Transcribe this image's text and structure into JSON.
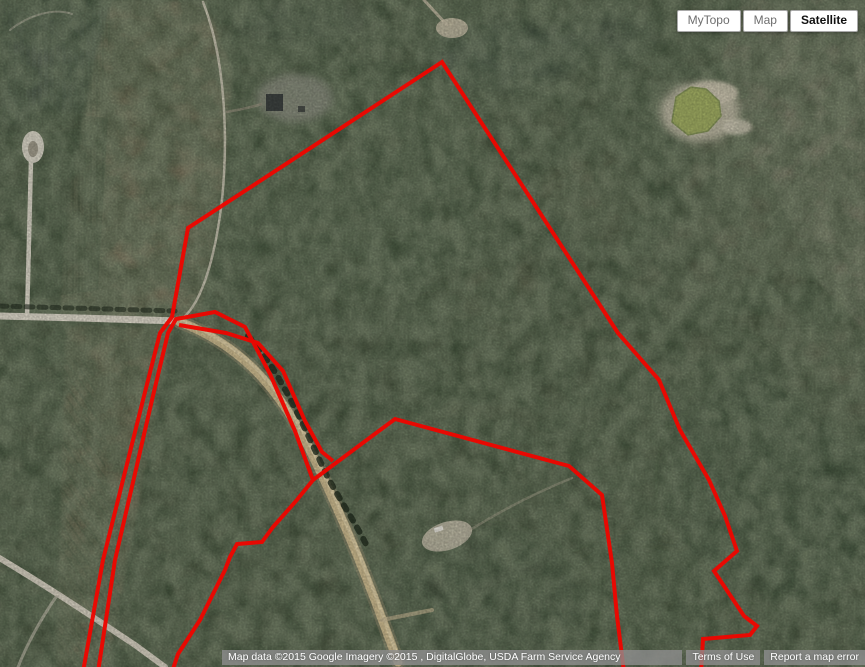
{
  "map_controls": {
    "buttons": [
      {
        "id": "mytopo",
        "label": "MyTopo",
        "active": false
      },
      {
        "id": "map",
        "label": "Map",
        "active": false
      },
      {
        "id": "satellite",
        "label": "Satellite",
        "active": true
      }
    ]
  },
  "attribution": {
    "map_data": "Map data ©2015 Google Imagery ©2015 , DigitalGlobe, USDA Farm Service Agency",
    "terms_of_use": "Terms of Use",
    "report_error": "Report a map error"
  },
  "overlay": {
    "stroke_color": "#ee0600",
    "stroke_width": 4,
    "polylines": [
      {
        "name": "main-parcel-boundary",
        "points": [
          [
            83,
            672
          ],
          [
            103,
            560
          ],
          [
            143,
            400
          ],
          [
            160,
            333
          ],
          [
            172,
            317
          ],
          [
            188,
            228
          ],
          [
            442,
            62
          ],
          [
            618,
            333
          ],
          [
            659,
            380
          ],
          [
            680,
            430
          ],
          [
            709,
            480
          ],
          [
            725,
            516
          ],
          [
            737,
            551
          ],
          [
            714,
            571
          ],
          [
            744,
            616
          ],
          [
            757,
            626
          ],
          [
            750,
            635
          ],
          [
            703,
            639
          ],
          [
            701,
            672
          ]
        ]
      },
      {
        "name": "west-strip-boundary",
        "points": [
          [
            98,
            672
          ],
          [
            115,
            560
          ],
          [
            152,
            400
          ],
          [
            168,
            333
          ],
          [
            176,
            319
          ],
          [
            215,
            312
          ],
          [
            245,
            327
          ],
          [
            270,
            374
          ],
          [
            295,
            431
          ],
          [
            313,
            480
          ],
          [
            296,
            501
          ],
          [
            273,
            527
          ],
          [
            262,
            542
          ],
          [
            237,
            544
          ],
          [
            230,
            557
          ],
          [
            225,
            570
          ],
          [
            200,
            620
          ],
          [
            178,
            654
          ],
          [
            172,
            672
          ]
        ]
      },
      {
        "name": "inner-parcel-east-boundary",
        "points": [
          [
            313,
            480
          ],
          [
            395,
            419
          ],
          [
            569,
            466
          ],
          [
            602,
            495
          ],
          [
            612,
            563
          ],
          [
            617,
            616
          ],
          [
            624,
            672
          ]
        ]
      },
      {
        "name": "corridor-south-boundary",
        "points": [
          [
            179,
            325
          ],
          [
            226,
            333
          ],
          [
            258,
            343
          ],
          [
            283,
            371
          ],
          [
            305,
            421
          ],
          [
            322,
            452
          ],
          [
            333,
            461
          ]
        ]
      }
    ]
  }
}
